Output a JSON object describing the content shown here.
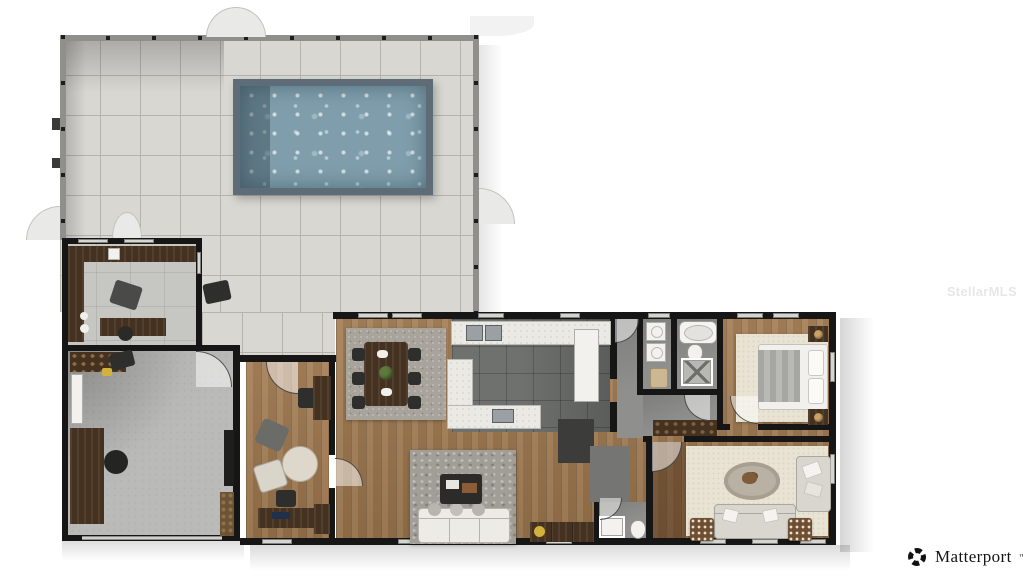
{
  "watermark": {
    "text": "StellarMLS"
  },
  "branding": {
    "logo_icon": "matterport-icon",
    "logo_text": "Matterport",
    "logo_tm": "™"
  },
  "colors": {
    "page_bg": "#ffffff",
    "deck_tile": "#d8d7d2",
    "deck_line": "#b4b3ae",
    "screen_wall": "#8f8f8c",
    "wall": "#161616",
    "window": "#d4d4d1",
    "pool_edge": "#5d6c76",
    "pool_water": "#7f9dab",
    "lanai_floor": "#c6c6c2",
    "concrete": "#babbb9",
    "wood": "#a17a50",
    "wood_dark": "#44311f",
    "dark_tile": "#6f716f",
    "counter": "#eae9e4",
    "steel": "#9aa0a3",
    "gray_floor": "#8f8f8d",
    "rug_cream": "#e9e3d3",
    "rug_gray": "#a8a49c",
    "rug_shag": "#a19d97",
    "sofa_white": "#edebe5",
    "sofa_gray": "#d8d6cf",
    "fixture_white": "#f2f1ee",
    "lamp_gold": "#c9a465",
    "plant_green": "#5d7a3a",
    "accent_yellow": "#d2b13d",
    "closet_dark": "#3c3c3b",
    "closet_gray": "#757573",
    "watermark_color": "#e7e7e7",
    "logo_color": "#141414"
  }
}
